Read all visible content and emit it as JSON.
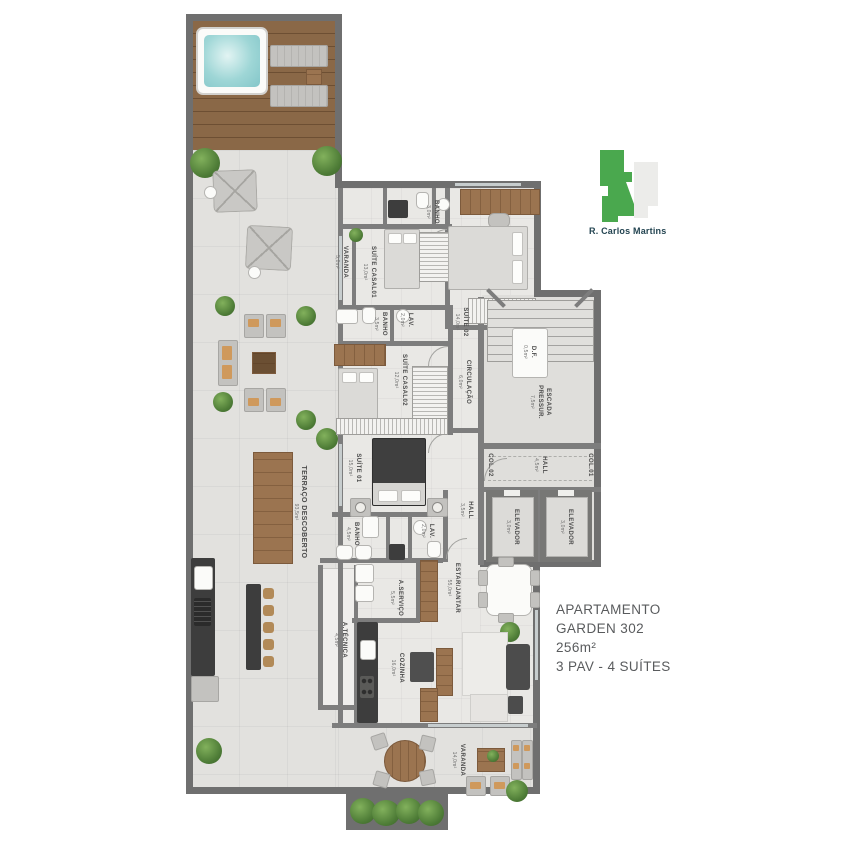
{
  "info_block": {
    "line1": "APARTAMENTO",
    "line2": "GARDEN 302",
    "line3": "256m²",
    "line4": "3 PAV - 4 SUÍTES"
  },
  "legend": {
    "street": "R. Carlos Martins",
    "active_color": "#4aa84e",
    "inactive_color": "#ececea"
  },
  "rooms": {
    "terraco": {
      "label": "TERRAÇO DESCOBERTO",
      "area": "93,5m²"
    },
    "varanda_top": {
      "label": "VARANDA",
      "area": "5,0m²"
    },
    "suite_casal01": {
      "label": "SUÍTE CASAL01",
      "area": "13,0m²"
    },
    "banho_top": {
      "label": "BANHO",
      "area": "3,0m²"
    },
    "suite02": {
      "label": "SUÍTE 02",
      "area": "14,0m²"
    },
    "banho_mid": {
      "label": "BANHO",
      "area": "3,5m²"
    },
    "lav_mid": {
      "label": "LAV.",
      "area": "2,0m²"
    },
    "suite_casal02": {
      "label": "SUÍTE CASAL02",
      "area": "12,0m²"
    },
    "circulacao": {
      "label": "CIRCULAÇÃO",
      "area": "6,0m²"
    },
    "df": {
      "label": "D.F.",
      "area": "0,5m²"
    },
    "escada": {
      "label": "ESCADA",
      "label2": "PRESSUR.",
      "area": "7,5m²"
    },
    "hall_social": {
      "label": "HALL",
      "area": "4,5m²"
    },
    "col02": {
      "label": "COL.02"
    },
    "col01": {
      "label": "COL.01"
    },
    "elevador1": {
      "label": "ELEVADOR",
      "area": "3,0m²"
    },
    "elevador2": {
      "label": "ELEVADOR",
      "area": "3,0m²"
    },
    "suite01": {
      "label": "SUÍTE 01",
      "area": "15,0m²"
    },
    "banho_suite01": {
      "label": "BANHO",
      "area": "4,5m²"
    },
    "lav_low": {
      "label": "LAV.",
      "area": "2,0m²"
    },
    "hall_intimo": {
      "label": "HALL",
      "area": "3,5m²"
    },
    "estar_jantar": {
      "label": "ESTAR/JANTAR",
      "area": "55,0m²"
    },
    "a_servico": {
      "label": "A.SERVIÇO",
      "area": "5,5m²"
    },
    "a_tecnica": {
      "label": "A.TÉCNICA",
      "area": "4,5m²"
    },
    "cozinha": {
      "label": "COZINHA",
      "area": "16,0m²"
    },
    "varanda_bottom": {
      "label": "VARANDA",
      "area": "14,0m²"
    }
  }
}
